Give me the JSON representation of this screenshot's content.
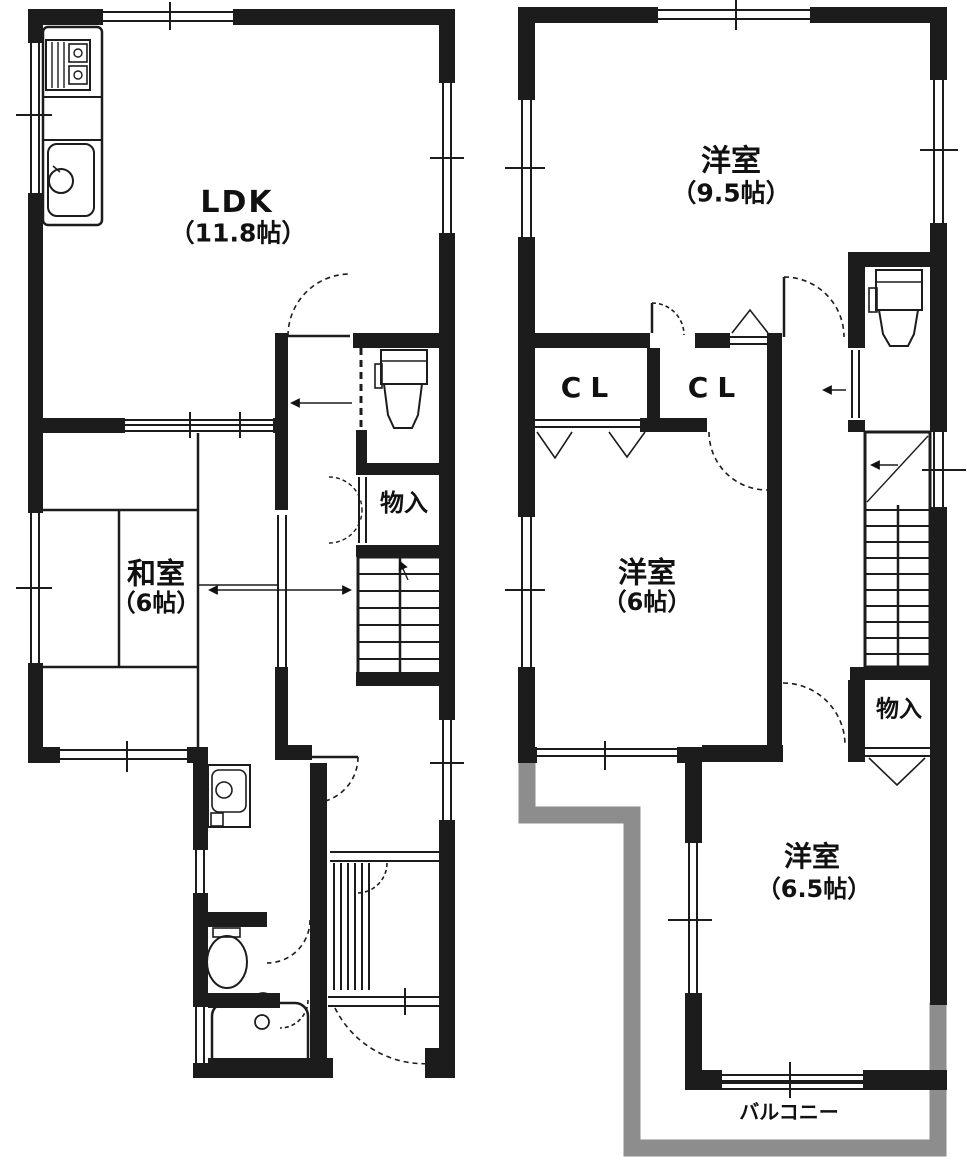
{
  "document_type": "floor-plan",
  "colors": {
    "wall": "#1c1c1c",
    "line": "#1c1c1c",
    "balcony": "#8d8d8d",
    "background": "#ffffff"
  },
  "plans": {
    "left": {
      "rooms": {
        "ldk": {
          "name": "LDK",
          "size": "（11.8帖）"
        },
        "washitsu": {
          "name": "和室",
          "size": "（6帖）"
        },
        "storage": {
          "name": "物入"
        }
      }
    },
    "right": {
      "rooms": {
        "bedroom_large": {
          "name": "洋室",
          "size": "（9.5帖）"
        },
        "closet_left": {
          "name": "CL"
        },
        "closet_right": {
          "name": "CL"
        },
        "bedroom_mid": {
          "name": "洋室",
          "size": "（6帖）"
        },
        "storage": {
          "name": "物入"
        },
        "bedroom_small": {
          "name": "洋室",
          "size": "（6.5帖）"
        },
        "balcony": {
          "name": "バルコニー"
        }
      }
    }
  }
}
